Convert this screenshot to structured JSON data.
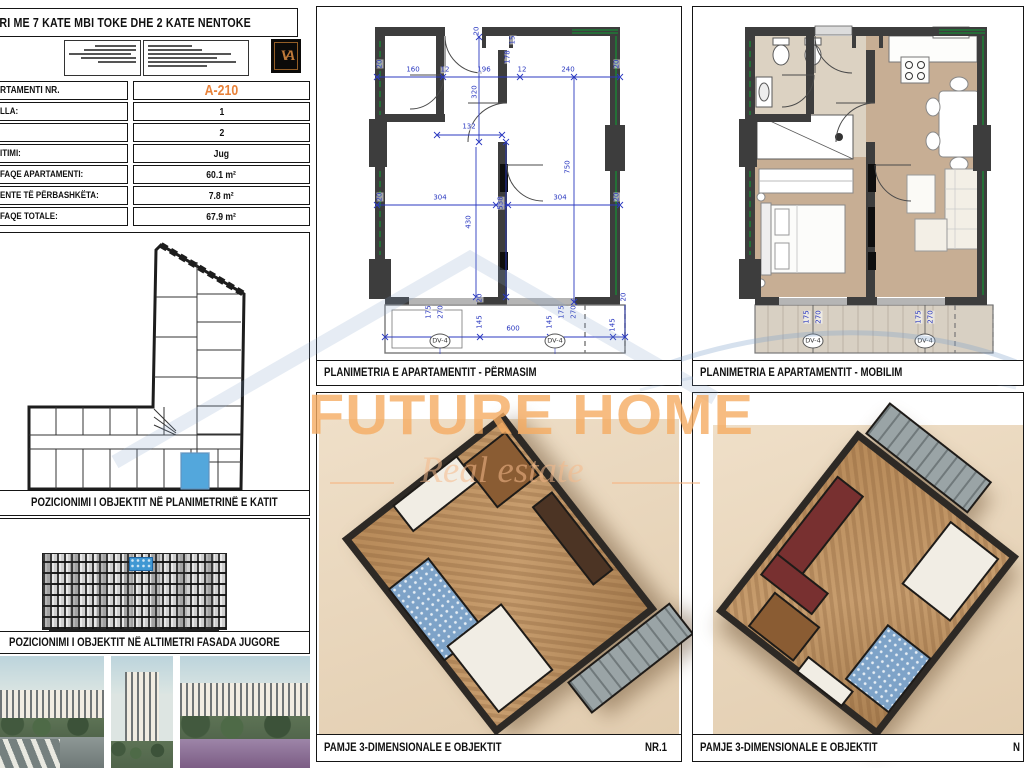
{
  "header": {
    "title": "DINE SHERBIMI HOTELIERI ME 7 KATE MBI TOKE DHE 2 KATE NENTOKE",
    "logo_monogram": "VA"
  },
  "apartment_table": {
    "rows": [
      {
        "label": "RTAMENTI NR.",
        "value": "A-210"
      },
      {
        "label": "LLA:",
        "value": "1"
      },
      {
        "label": "",
        "value": "2"
      },
      {
        "label": "ITIMI:",
        "value": "Jug"
      },
      {
        "label": "FAQE APARTAMENTI:",
        "value": "60.1 m²"
      },
      {
        "label": "ENTE TË PËRBASHKËTA:",
        "value": "7.8 m²"
      },
      {
        "label": "FAQE TOTALE:",
        "value": "67.9 m²"
      }
    ],
    "accent_color": "#e8823a"
  },
  "captions": {
    "key_plan": "POZICIONIMI I OBJEKTIT NË PLANIMETRINË E KATIT",
    "elevation": "POZICIONIMI I OBJEKTIT NË ALTIMETRI FASADA JUGORE",
    "plan_dimensioned": "PLANIMETRIA E APARTAMENTIT - PËRMASIM",
    "plan_furnished": "PLANIMETRIA E APARTAMENTIT - MOBILIM",
    "view3d": "PAMJE 3-DIMENSIONALE E OBJEKTIT",
    "view3d_nr_1": "NR.1",
    "view3d_nr_2": "N"
  },
  "watermark": {
    "line1": "FUTURE HOME",
    "line2": "Real estate",
    "accent": "#f6b26b",
    "blue": "#7da0c8"
  },
  "colors": {
    "dim_blue": "#2b39c0",
    "wall": "#3d3d3d",
    "glazing_green": "#1e7d36",
    "highlight_blue": "#4aa0d8",
    "floor_wood": "#c7ae94",
    "balcony": "#d8d0c3"
  },
  "plan_dims": [
    {
      "t": "20",
      "x": 63,
      "y": 57,
      "r": 1
    },
    {
      "t": "160",
      "x": 96,
      "y": 63
    },
    {
      "t": "12",
      "x": 128,
      "y": 63
    },
    {
      "t": "196",
      "x": 167,
      "y": 63
    },
    {
      "t": "178",
      "x": 191,
      "y": 50,
      "r": 1
    },
    {
      "t": "12",
      "x": 205,
      "y": 63
    },
    {
      "t": "240",
      "x": 251,
      "y": 63
    },
    {
      "t": "20",
      "x": 300,
      "y": 57,
      "r": 1
    },
    {
      "t": "20",
      "x": 160,
      "y": 24,
      "r": 1
    },
    {
      "t": "15",
      "x": 196,
      "y": 33,
      "r": 1
    },
    {
      "t": "320",
      "x": 158,
      "y": 85,
      "r": 1
    },
    {
      "t": "132",
      "x": 152,
      "y": 120
    },
    {
      "t": "304",
      "x": 123,
      "y": 191
    },
    {
      "t": "538",
      "x": 184,
      "y": 196,
      "r": 1
    },
    {
      "t": "304",
      "x": 243,
      "y": 191
    },
    {
      "t": "20",
      "x": 63,
      "y": 190,
      "r": 1
    },
    {
      "t": "20",
      "x": 300,
      "y": 190,
      "r": 1
    },
    {
      "t": "430",
      "x": 152,
      "y": 215,
      "r": 1
    },
    {
      "t": "750",
      "x": 251,
      "y": 160,
      "r": 1
    },
    {
      "t": "20",
      "x": 163,
      "y": 291,
      "r": 1
    },
    {
      "t": "175",
      "x": 112,
      "y": 305,
      "r": 1
    },
    {
      "t": "270",
      "x": 124,
      "y": 305,
      "r": 1
    },
    {
      "t": "145",
      "x": 163,
      "y": 315,
      "r": 1
    },
    {
      "t": "600",
      "x": 196,
      "y": 322
    },
    {
      "t": "145",
      "x": 233,
      "y": 315,
      "r": 1
    },
    {
      "t": "175",
      "x": 245,
      "y": 305,
      "r": 1
    },
    {
      "t": "270",
      "x": 257,
      "y": 305,
      "r": 1
    },
    {
      "t": "145",
      "x": 296,
      "y": 318,
      "r": 1
    },
    {
      "t": "20",
      "x": 307,
      "y": 290,
      "r": 1
    },
    {
      "t": "DV-4",
      "x": 123,
      "y": 334,
      "c": 1
    },
    {
      "t": "DV-4",
      "x": 238,
      "y": 334,
      "c": 1
    }
  ],
  "furn_dims": [
    {
      "t": "175",
      "x": 114,
      "y": 310,
      "r": 1
    },
    {
      "t": "270",
      "x": 126,
      "y": 310,
      "r": 1
    },
    {
      "t": "DV-4",
      "x": 120,
      "y": 334,
      "c": 1
    },
    {
      "t": "175",
      "x": 226,
      "y": 310,
      "r": 1
    },
    {
      "t": "270",
      "x": 238,
      "y": 310,
      "r": 1
    },
    {
      "t": "DV-4",
      "x": 232,
      "y": 334,
      "c": 1
    }
  ]
}
